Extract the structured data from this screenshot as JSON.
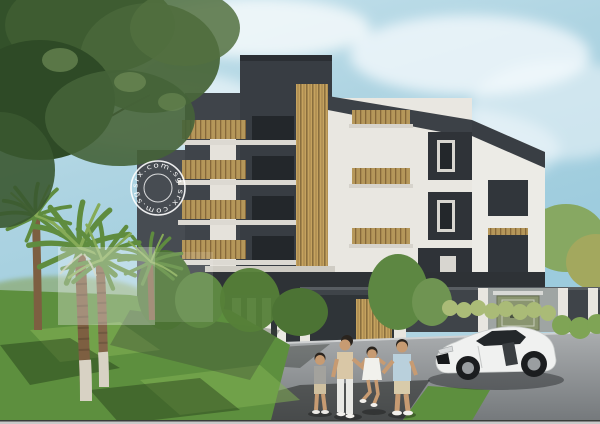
{
  "scene": {
    "type": "architectural_rendering",
    "subject": "Modern low-rise condominium exterior with landscaped grounds",
    "elements": [
      "blue sky with soft clouds",
      "large overhanging tree canopy",
      "fan palm trees on lawn",
      "five-storey dark-and-white condominium with timber slat feature column",
      "balconies with timber railings",
      "boundary wall with white fence pillars and entrance gate",
      "green address sign on wall",
      "lawn with light and shadow patches",
      "grey driveway",
      "family of four walking and swinging a child",
      "white sports coupe parked near garage",
      "circular agency watermark stamp",
      "translucent watermark box on lawn"
    ]
  },
  "watermark": {
    "stamp_text": "srx.com.sg srx.com.sg"
  },
  "signage": {
    "address_number": "24"
  },
  "palette": {
    "sky": "#afd4e2",
    "cloud": "#f4fafc",
    "building_dark": "#3b4046",
    "building_white": "#eae8e2",
    "timber": "#c5a35f",
    "foliage_dark": "#33512a",
    "foliage_light": "#7da35c",
    "lawn": "#5d8f3e",
    "driveway": "#909496",
    "boundary_wall": "#3f4449",
    "car_body": "#f0f1f0",
    "watermark_white": "#ffffff"
  }
}
